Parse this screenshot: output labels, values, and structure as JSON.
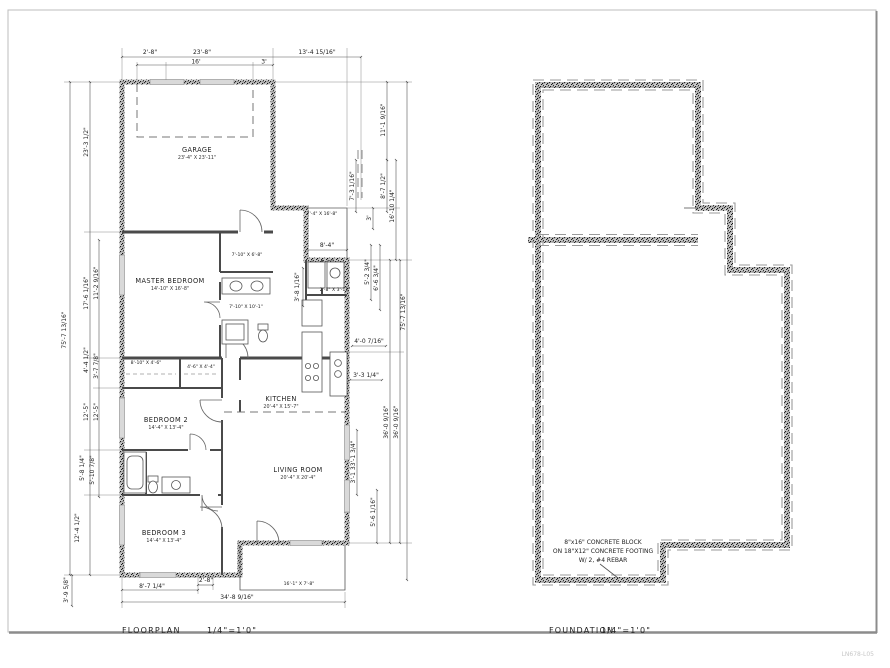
{
  "floorplan": {
    "title": "FLOORPLAN",
    "scale": "1/4\"=1'0\"",
    "rooms": {
      "garage": {
        "name": "GARAGE",
        "size": "23'-4\" X 23'-11\""
      },
      "master": {
        "name": "MASTER BEDROOM",
        "size": "14'-10\" X 16'-8\""
      },
      "bedroom2": {
        "name": "BEDROOM 2",
        "size": "14'-4\" X 13'-4\""
      },
      "bedroom3": {
        "name": "BEDROOM 3",
        "size": "14'-4\" X 13'-4\""
      },
      "kitchen": {
        "name": "KITCHEN",
        "size": "20'-4\" X 15'-7\""
      },
      "living": {
        "name": "LIVING ROOM",
        "size": "20'-4\" X 20'-4\""
      }
    },
    "areas": {
      "closet_master": "7'-10\" X 6'-8\"",
      "master_bath": "7'-10\" X 10'-1\"",
      "closet_hall": "8'-10\" X 4'-6\"",
      "closet_small": "4'-6\" X 4'-4\"",
      "laundry": "2'-8\" X 3'-11\"",
      "entry_porch": "7'-4\" X 16'-8\"",
      "rear_porch": "16'-1\" X 7'-8\""
    },
    "dims": {
      "top": [
        "2'-8\"",
        "23'-8\"",
        "13'-4 15/16\"",
        "16'",
        "3'"
      ],
      "left": [
        "75'-7 13/16\"",
        "23'-3 1/2\"",
        "17'-6 1/16\"",
        "11'-2 9/16\"",
        "4'-4 1/2\"",
        "3'-7 7/8\"",
        "12'-5\"",
        "12'-5\"",
        "5'-8 1/4\"",
        "5'-10 7/8\"",
        "12'-4 1/2\"",
        "3'-9 5/8\""
      ],
      "right": [
        "11'-1 9/16\"",
        "7'-3 1/16\"",
        "8'-7 1/2\"",
        "16'-10 1/4\"",
        "3'",
        "8'-4\"",
        "5'-2 3/4\"",
        "6'-6 3/4\"",
        "3'-8 1/16\"",
        "4'-0 7/16\"",
        "3'-3 1/4\"",
        "3'-1 33'-1 3/4\"",
        "36'-0 9/16\"",
        "36'-0 9/16\"",
        "5'-6 1/16\"",
        "75'-7 13/16\""
      ],
      "bottom": [
        "8'-7 1/4\"",
        "2'-8\"",
        "34'-8 9/16\""
      ]
    }
  },
  "foundation": {
    "title": "FOUNDATION",
    "scale": "1/4\"=1'0\"",
    "note": [
      "8\"x16\" CONCRETE BLOCK",
      "ON 18\"X12\" CONCRETE FOOTING",
      "W/ 2, #4 REBAR"
    ]
  },
  "watermark": "LN678-L05"
}
